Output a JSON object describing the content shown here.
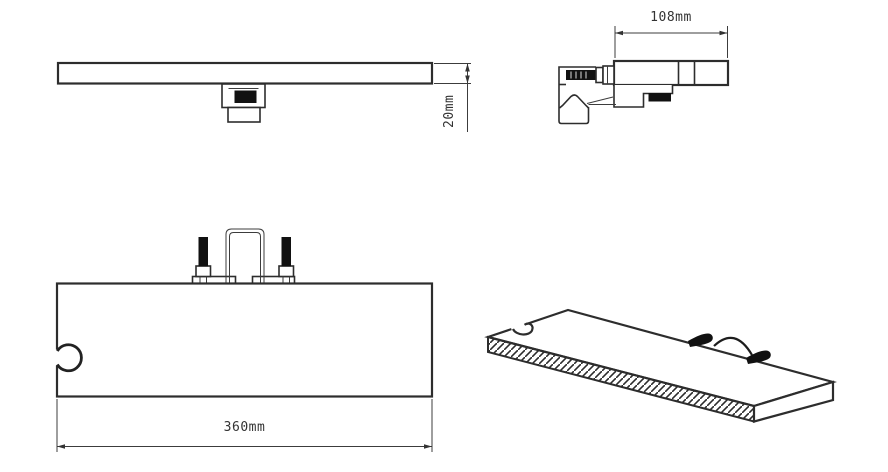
{
  "drawing": {
    "background_color": "#ffffff",
    "line_color": "#2d2d2d",
    "black_fill_color": "#111111",
    "dimensions": {
      "bar_thickness": "20mm",
      "bracket_depth": "108mm",
      "shelf_width": "360mm"
    }
  }
}
